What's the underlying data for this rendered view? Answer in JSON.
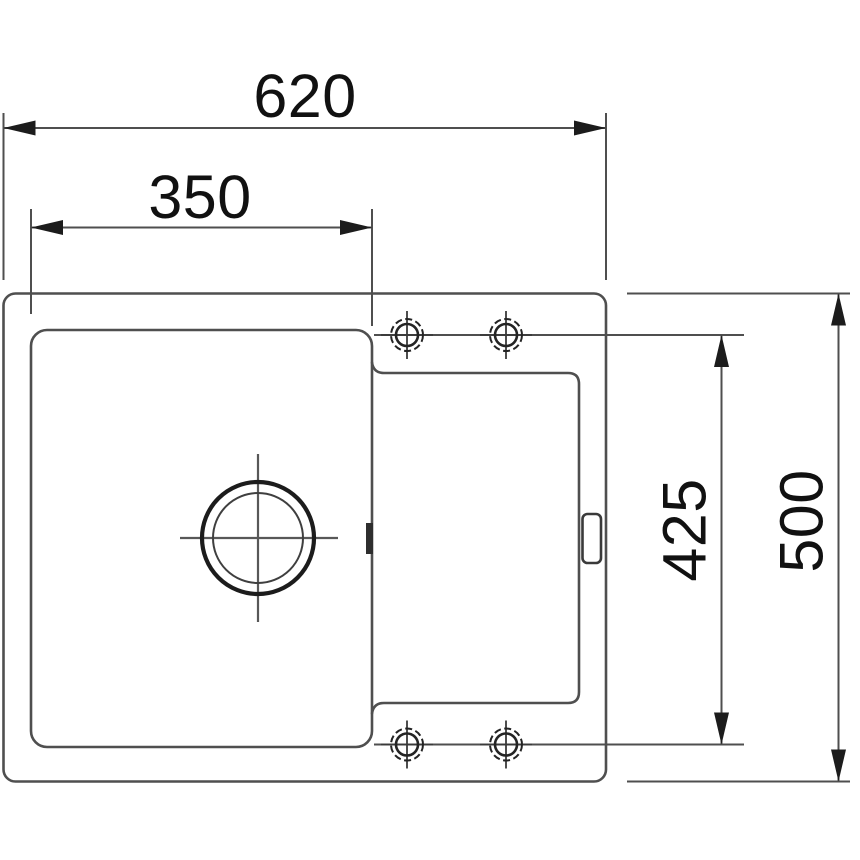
{
  "colors": {
    "line": "#4f4f4f",
    "dark": "#1c1c1c",
    "text": "#111111",
    "background": "#ffffff"
  },
  "dimensions": {
    "overall_width": "620",
    "bowl_width": "350",
    "tap_axis_span": "425",
    "overall_depth": "500"
  }
}
